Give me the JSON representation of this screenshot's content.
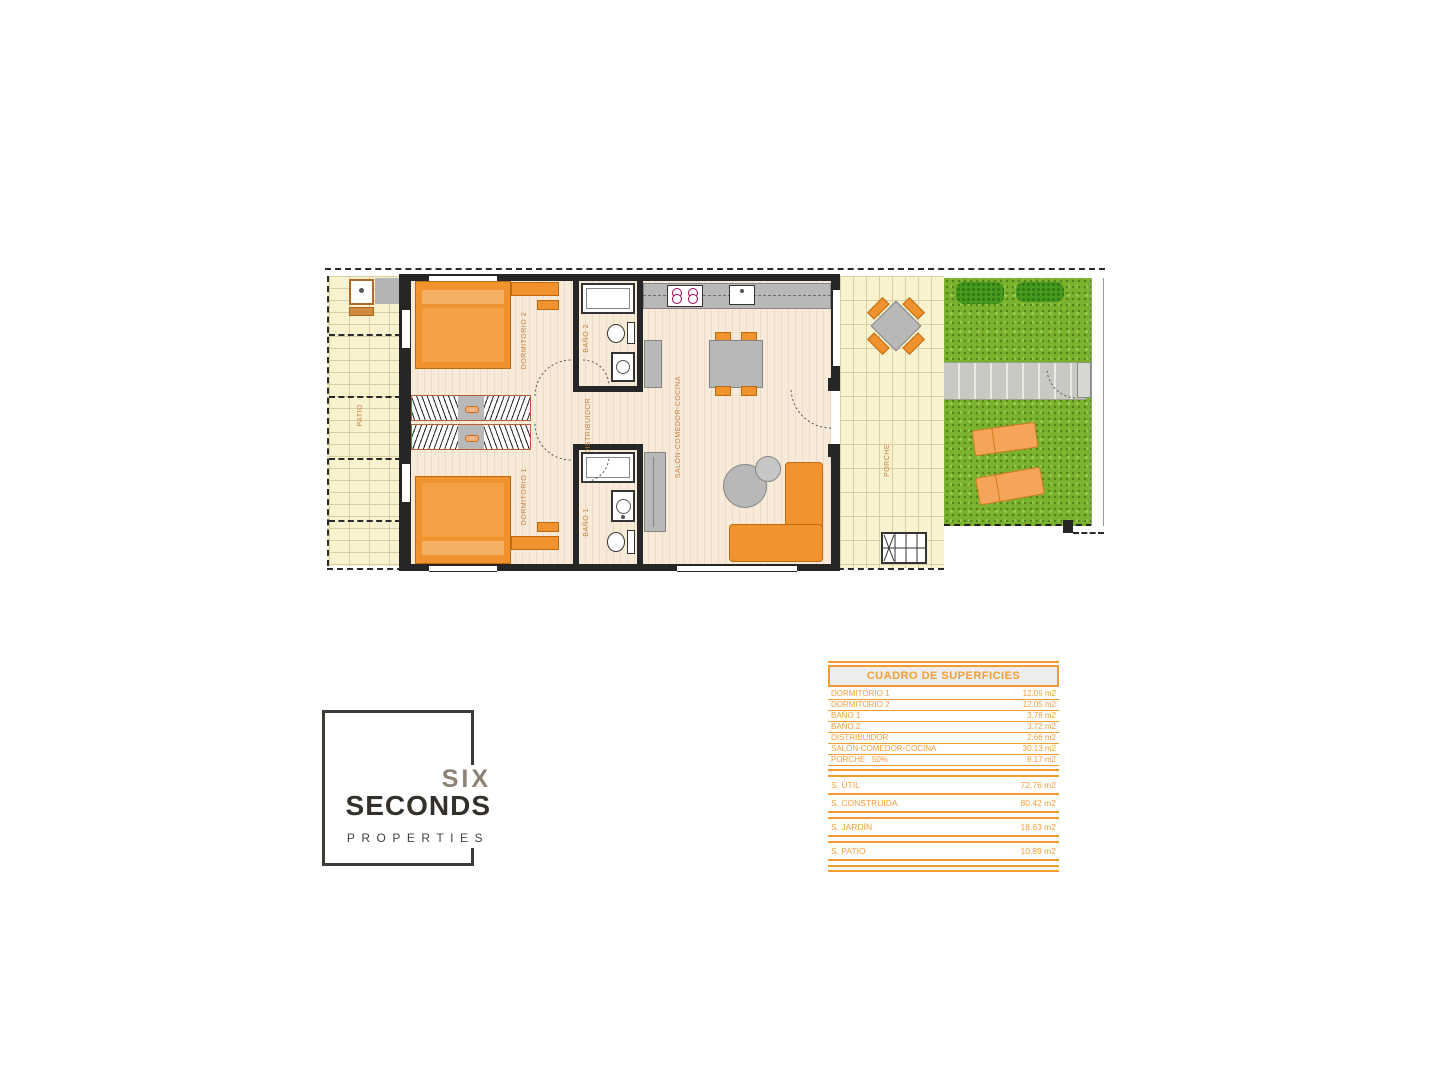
{
  "colors": {
    "accent_orange": "#F0922D",
    "table_orange": "#F49E37",
    "garden_green": "#7CB32E",
    "floor_cream": "#F8EADA",
    "paving_yellow": "#F8F2CF",
    "furniture_gray": "#B8B8B8",
    "wall_dark": "#262626"
  },
  "plan": {
    "rooms": {
      "patio": "PATIO",
      "dormitorio_2": "DORMITORIO 2",
      "dormitorio_1": "DORMITORIO 1",
      "bano_2": "BAÑO 2",
      "bano_1": "BAÑO 1",
      "distribuidor": "DISTRIBUIDOR",
      "salon": "SALÓN-COMEDOR-COCINA",
      "porche": "PORCHE"
    }
  },
  "surfaces_table": {
    "title": "CUADRO DE SUPERFICIES",
    "rows": [
      {
        "label": "DORMITORIO 1",
        "value": "12.05 m2"
      },
      {
        "label": "DORMITORIO 2",
        "value": "12.05 m2"
      },
      {
        "label": "BAÑO 1",
        "value": "3.78 m2"
      },
      {
        "label": "BAÑO 2",
        "value": "3.72 m2"
      },
      {
        "label": "DISTRIBUIDOR",
        "value": "2.66 m2"
      },
      {
        "label": "SALÓN-COMEDOR-COCINA",
        "value": "30.13 m2"
      },
      {
        "label": "PORCHE   50%",
        "value": "8.17 m2"
      }
    ],
    "summary": [
      {
        "label": "S. ÚTIL",
        "value": "72.76 m2"
      },
      {
        "label": "S. CONSTRUIDA",
        "value": "80.42 m2"
      },
      {
        "label": "S. JARDÍN",
        "value": "18.63 m2"
      },
      {
        "label": "S. PATIO",
        "value": "10.89 m2"
      }
    ]
  },
  "logo": {
    "line1": "SIX",
    "line2": "SECONDS",
    "line3": "PROPERTIES"
  }
}
